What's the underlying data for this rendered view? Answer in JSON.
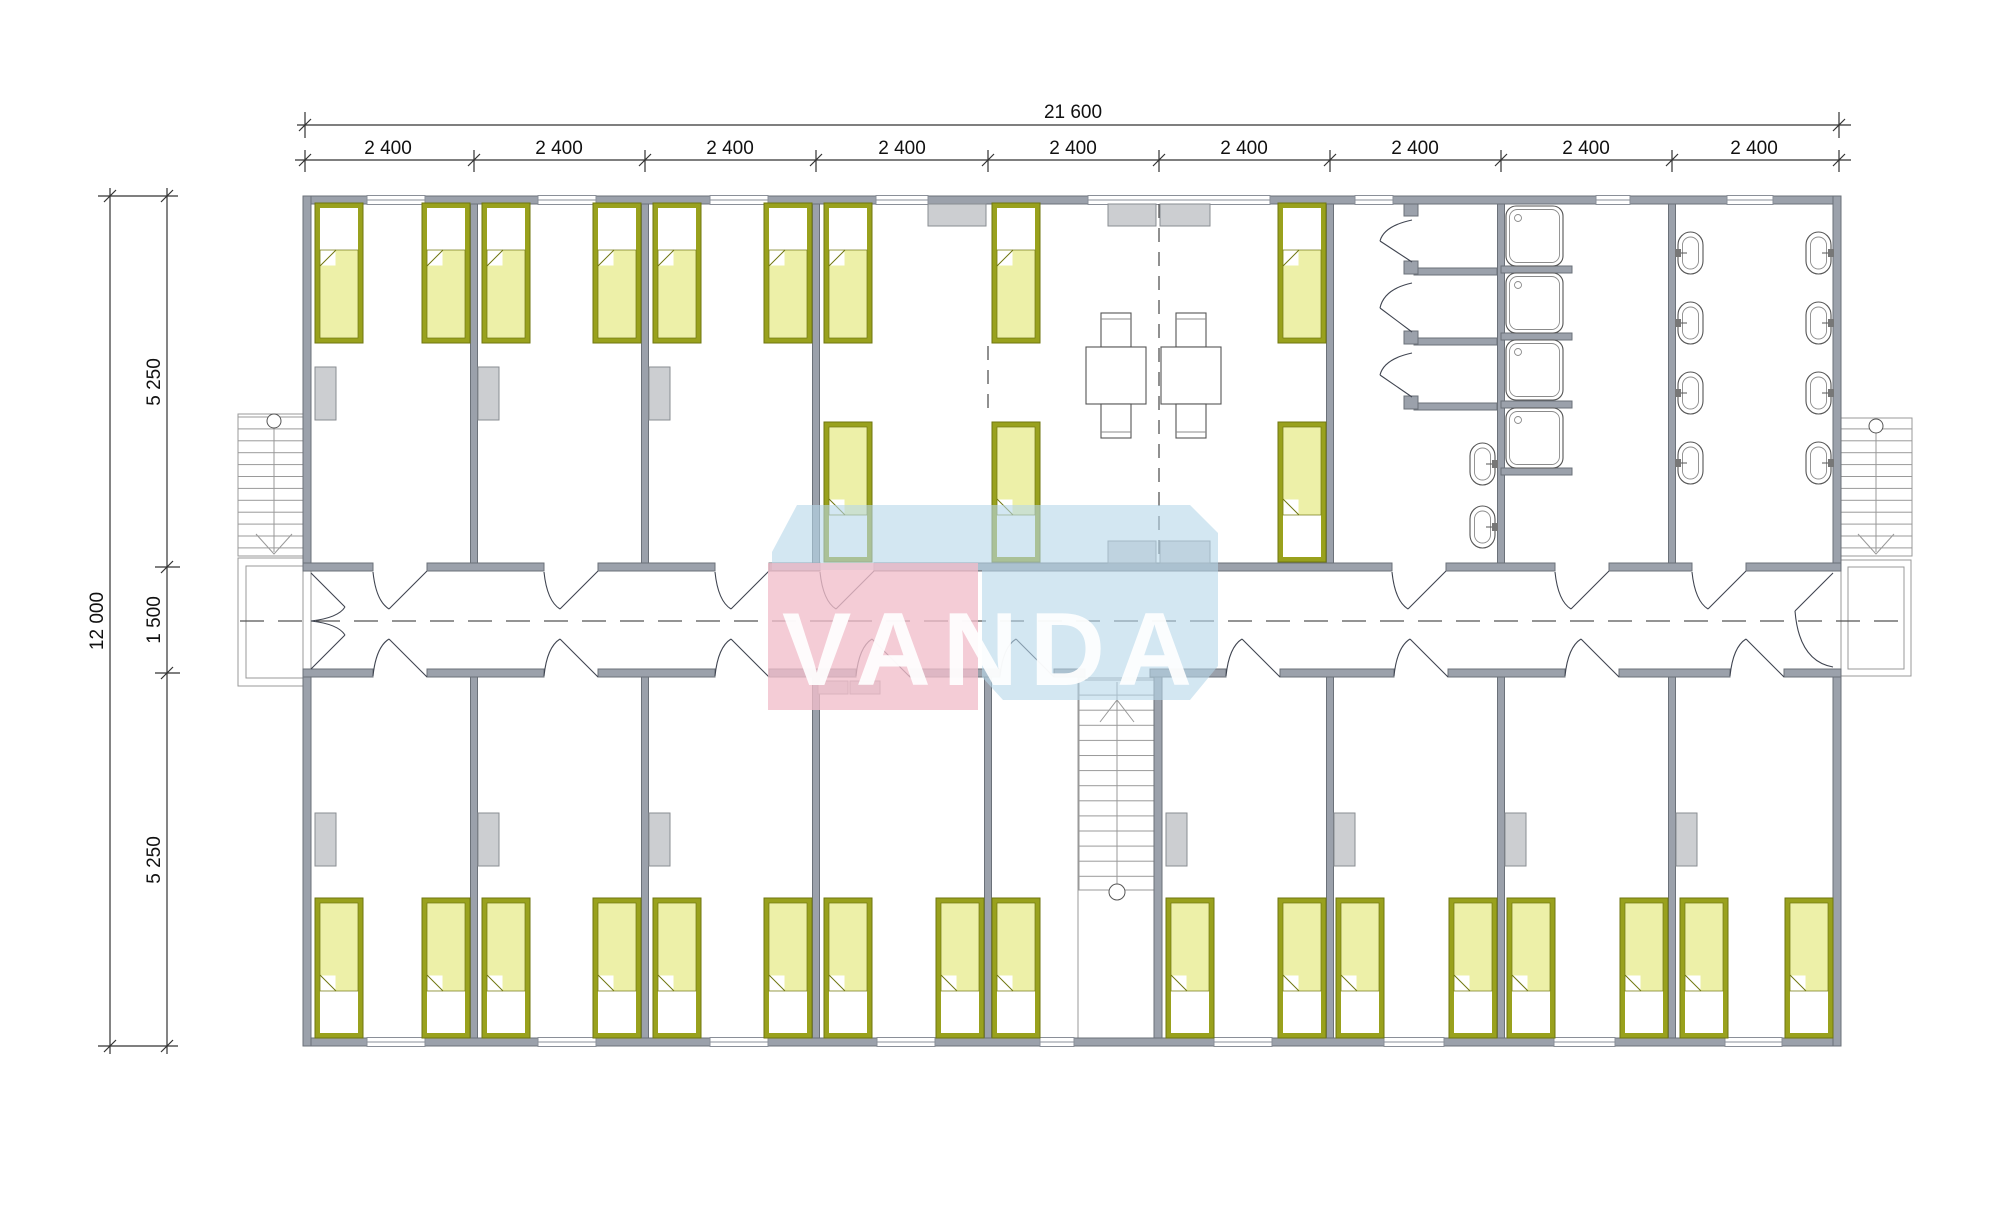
{
  "drawing": {
    "type": "architectural floor plan",
    "description": "dormitory floor plan with central corridor"
  },
  "dimensions": {
    "top": {
      "overall_label": "21 600",
      "segment_labels": [
        "2 400",
        "2 400",
        "2 400",
        "2 400",
        "2 400",
        "2 400",
        "2 400",
        "2 400",
        "2 400"
      ]
    },
    "left": {
      "overall_label": "12 000",
      "segment_labels": [
        "5 250",
        "1 500",
        "5 250"
      ]
    }
  },
  "watermark": {
    "text": "VANDA"
  },
  "colors": {
    "wall": "#9ba1ab",
    "walledge": "#6b7179",
    "bedframe": "#99a11d",
    "bededge": "#6f760f",
    "bedfill": "#edf0a8",
    "furn": "#ccced1",
    "furnedge": "#898d92",
    "line": "#3f4450",
    "thin": "#8a8f98",
    "dash": "#555555",
    "wmblue": "#b5d7ea",
    "wmpink": "#f1becb",
    "wmtext": "#ffffff"
  },
  "fixtures": {
    "bed": "single bed",
    "wardrobe": "wardrobe",
    "dining_table": "table with two chairs",
    "shower_stall": "shower stall with door",
    "shower_tray": "shower tray",
    "wash_basin": "wash basin",
    "staircase": "staircase"
  },
  "counts": {
    "beds": 29,
    "shower_stalls": 3,
    "shower_trays": 4,
    "wash_basins": 10,
    "dining_tables": 2,
    "staircases": 3
  }
}
